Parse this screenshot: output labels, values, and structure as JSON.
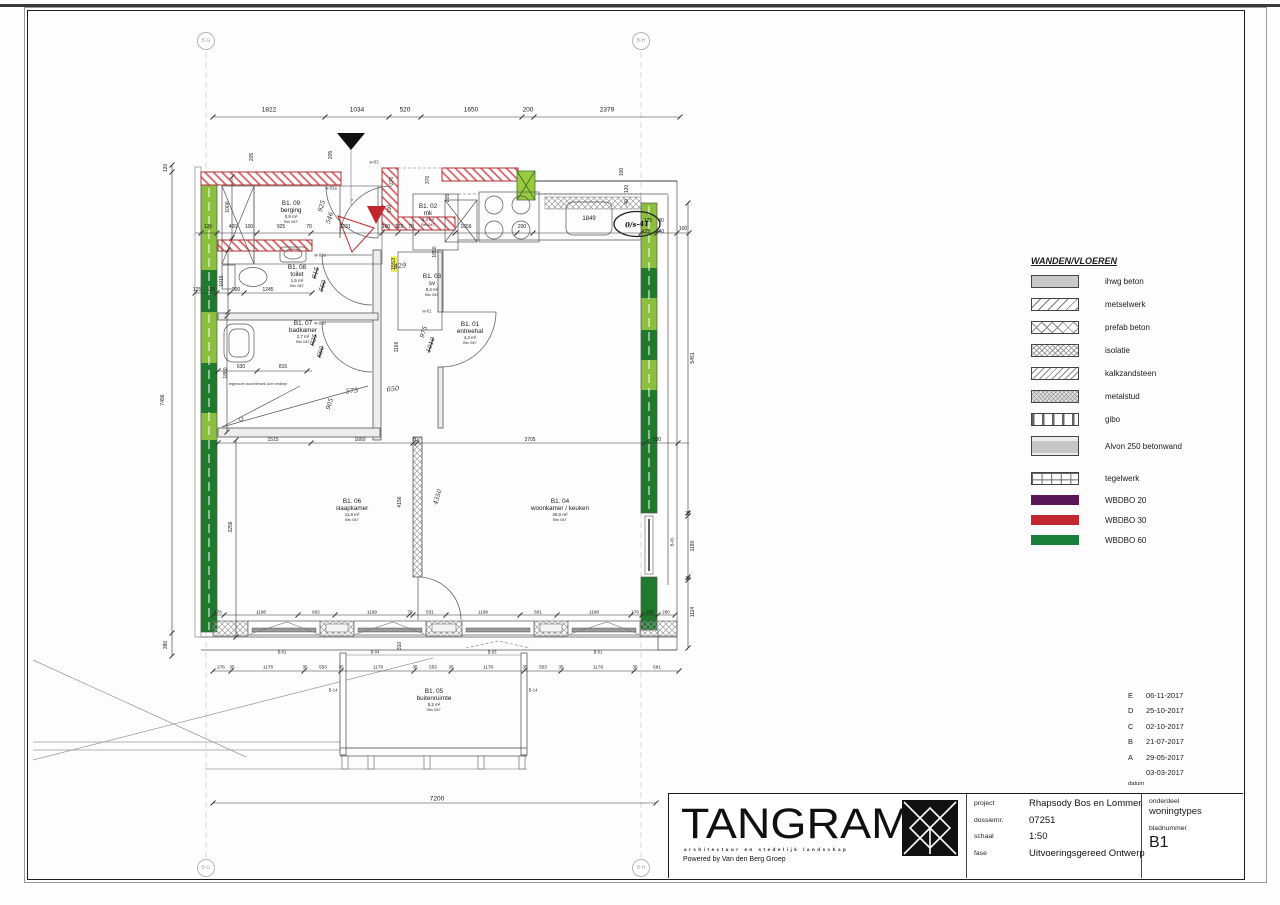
{
  "colors": {
    "accent_red": "#c1272d",
    "green_light": "#8cbf3f",
    "green_dark": "#1f7a2d",
    "purple": "#5a1758",
    "green_legend": "#188038",
    "highlight": "#f3ef52"
  },
  "grid_markers": [
    {
      "label": "B-G",
      "x": 206,
      "y": 41
    },
    {
      "label": "B-H",
      "x": 641,
      "y": 41
    },
    {
      "label": "B-G",
      "x": 206,
      "y": 868
    },
    {
      "label": "B-H",
      "x": 641,
      "y": 868
    }
  ],
  "legend": {
    "title": "WANDEN/VLOEREN",
    "items": [
      {
        "label": "ihwg beton",
        "pattern": "solid"
      },
      {
        "label": "metselwerk",
        "pattern": "diag"
      },
      {
        "label": "prefab beton",
        "pattern": "crossx"
      },
      {
        "label": "isolatie",
        "pattern": "dense"
      },
      {
        "label": "kalkzandsteen",
        "pattern": "diag2"
      },
      {
        "label": "metalstud",
        "pattern": "metal"
      },
      {
        "label": "gibo",
        "pattern": "vbars"
      },
      {
        "label": "Alvon 250 betonwand",
        "pattern": "alvon"
      },
      {
        "label": "tegelwerk",
        "pattern": "tiles",
        "gap": true
      },
      {
        "label": "WBDBO 20",
        "pattern": "bar",
        "color": "#5a1758"
      },
      {
        "label": "WBDBO 30",
        "pattern": "bar",
        "color": "#c1272d"
      },
      {
        "label": "WBDBO 60",
        "pattern": "bar",
        "color": "#188038"
      }
    ]
  },
  "revisions": {
    "rows": [
      {
        "letter": "E",
        "date": "06-11-2017"
      },
      {
        "letter": "D",
        "date": "25-10-2017"
      },
      {
        "letter": "C",
        "date": "02-10-2017"
      },
      {
        "letter": "B",
        "date": "21-07-2017"
      },
      {
        "letter": "A",
        "date": "29-05-2017"
      },
      {
        "letter": "",
        "date": "03-03-2017"
      }
    ],
    "footer": "datum"
  },
  "titleblock": {
    "logo_text": "TANGRAM",
    "logo_tagline": "architectuur en stedelijk landschap",
    "logo_powered": "Powered by Van den Berg Groep",
    "fields": [
      {
        "label": "project",
        "value": "Rhapsody Bos en Lommer"
      },
      {
        "label": "dossiernr.",
        "value": "07251"
      },
      {
        "label": "schaal",
        "value": "1:50"
      },
      {
        "label": "fase",
        "value": "Uitvoeringsgereed Ontwerp"
      }
    ],
    "onderdeel_label": "onderdeel",
    "onderdeel_value": "woningtypes",
    "bladnummer_label": "bladnummer",
    "bladnummer_value": "B1"
  },
  "rooms": [
    {
      "id": "B1. 09",
      "name": "berging",
      "area": "0,9 m²",
      "code": "Brv 047",
      "x": 291,
      "y": 212
    },
    {
      "id": "B1. 08",
      "name": "toilet",
      "area": "1,5 m²",
      "code": "Brv 047",
      "x": 297,
      "y": 276
    },
    {
      "id": "B1. 07",
      "name": "badkamer",
      "area": "2,7 m²",
      "code": "Brv 047",
      "x": 303,
      "y": 332
    },
    {
      "id": "B1. 01",
      "name": "entreehal",
      "area": "4,4 m²",
      "code": "Brv 047",
      "x": 470,
      "y": 333
    },
    {
      "id": "B1. 02",
      "name": "mk",
      "area": "0,3 m²",
      "code": "Brv 047",
      "x": 428,
      "y": 215
    },
    {
      "id": "B1. 03",
      "name": "sv",
      "area": "0,4 m²",
      "code": "Brv 047",
      "x": 432,
      "y": 285
    },
    {
      "id": "B1. 06",
      "name": "slaapkamer",
      "area": "11,8 m²",
      "code": "Brv 047",
      "x": 352,
      "y": 510
    },
    {
      "id": "B1. 04",
      "name": "woonkamer / keuken",
      "area": "26,0 m²",
      "code": "Brv 047",
      "x": 560,
      "y": 510
    },
    {
      "id": "B1. 05",
      "name": "buitenruimte",
      "area": "5,2 m²",
      "code": "Brv 047",
      "x": 434,
      "y": 700
    }
  ],
  "plan_labels": [
    [
      "1822",
      269,
      110,
      "dB"
    ],
    [
      "1034",
      357,
      110,
      "dB"
    ],
    [
      "520",
      405,
      110,
      "dB"
    ],
    [
      "1650",
      471,
      110,
      "dB"
    ],
    [
      "200",
      528,
      110,
      "dB"
    ],
    [
      "2379",
      607,
      110,
      "dB"
    ],
    [
      "125",
      208,
      227,
      "d"
    ],
    [
      "420",
      233,
      227,
      "d"
    ],
    [
      "100",
      249,
      227,
      "d"
    ],
    [
      "925",
      281,
      227,
      "d"
    ],
    [
      "70",
      309,
      227,
      "d"
    ],
    [
      "1231",
      345,
      227,
      "d"
    ],
    [
      "100",
      386,
      227,
      "d"
    ],
    [
      "329",
      399,
      227,
      "d"
    ],
    [
      "70",
      411,
      227,
      "d"
    ],
    [
      "1656",
      466,
      227,
      "d"
    ],
    [
      "200",
      522,
      227,
      "d"
    ],
    [
      "1849",
      589,
      219,
      "d6"
    ],
    [
      "125",
      648,
      221,
      "d"
    ],
    [
      "40",
      661,
      221,
      "d"
    ],
    [
      "125",
      646,
      232,
      "d"
    ],
    [
      "140",
      660,
      232,
      "d"
    ],
    [
      "100",
      683,
      229,
      "d"
    ],
    [
      "120",
      166,
      168,
      "v"
    ],
    [
      "7496",
      163,
      400,
      "v"
    ],
    [
      "380",
      166,
      645,
      "v"
    ],
    [
      "205",
      252,
      157,
      "v"
    ],
    [
      "1000",
      228,
      207,
      "v"
    ],
    [
      "1015",
      222,
      281,
      "v"
    ],
    [
      "1880",
      226,
      373,
      "v"
    ],
    [
      "3256",
      231,
      527,
      "v"
    ],
    [
      "205",
      331,
      155,
      "v"
    ],
    [
      "276",
      392,
      181,
      "v"
    ],
    [
      "376",
      428,
      180,
      "v"
    ],
    [
      "205",
      448,
      198,
      "v"
    ],
    [
      "100",
      390,
      209,
      "v"
    ],
    [
      "1650",
      435,
      252,
      "v"
    ],
    [
      "1553",
      394,
      264,
      "vh"
    ],
    [
      "1166",
      397,
      347,
      "v"
    ],
    [
      "4156",
      400,
      502,
      "v"
    ],
    [
      "310",
      400,
      646,
      "v"
    ],
    [
      "100",
      622,
      172,
      "v"
    ],
    [
      "120",
      627,
      189,
      "v"
    ],
    [
      "40",
      627,
      202,
      "v"
    ],
    [
      "5451",
      693,
      358,
      "v"
    ],
    [
      "35",
      688,
      514,
      "d"
    ],
    [
      "1180",
      693,
      546,
      "v"
    ],
    [
      "35",
      688,
      579,
      "d"
    ],
    [
      "1114",
      693,
      612,
      "v"
    ],
    [
      "1515",
      273,
      440,
      "d"
    ],
    [
      "1660",
      360,
      440,
      "d"
    ],
    [
      "70",
      415,
      440,
      "d"
    ],
    [
      "3705",
      530,
      440,
      "d"
    ],
    [
      "530",
      657,
      440,
      "d"
    ],
    [
      "125",
      197,
      290,
      "d"
    ],
    [
      "125",
      211,
      290,
      "d"
    ],
    [
      "200",
      236,
      290,
      "d"
    ],
    [
      "1245",
      268,
      290,
      "d"
    ],
    [
      "630",
      241,
      367,
      "d"
    ],
    [
      "815",
      283,
      367,
      "d"
    ],
    [
      "176",
      218,
      612,
      "d45"
    ],
    [
      "1198",
      261,
      612,
      "d45"
    ],
    [
      "602",
      316,
      612,
      "d45"
    ],
    [
      "1199",
      372,
      612,
      "d45"
    ],
    [
      "70",
      410,
      612,
      "d45"
    ],
    [
      "531",
      430,
      612,
      "d45"
    ],
    [
      "1199",
      483,
      612,
      "d45"
    ],
    [
      "601",
      538,
      612,
      "d45"
    ],
    [
      "1198",
      594,
      612,
      "d45"
    ],
    [
      "176",
      635,
      612,
      "d45"
    ],
    [
      "255",
      650,
      612,
      "d45"
    ],
    [
      "280",
      666,
      612,
      "d45"
    ],
    [
      "276",
      221,
      667,
      "d45"
    ],
    [
      "35",
      232,
      667,
      "d45"
    ],
    [
      "1178",
      268,
      667,
      "d45"
    ],
    [
      "35",
      305,
      667,
      "d45"
    ],
    [
      "553",
      323,
      667,
      "d45"
    ],
    [
      "35",
      341,
      667,
      "d45"
    ],
    [
      "1178",
      378,
      667,
      "d45"
    ],
    [
      "35",
      415,
      667,
      "d45"
    ],
    [
      "553",
      433,
      667,
      "d45"
    ],
    [
      "35",
      451,
      667,
      "d45"
    ],
    [
      "1178",
      488,
      667,
      "d45"
    ],
    [
      "35",
      525,
      667,
      "d45"
    ],
    [
      "553",
      543,
      667,
      "d45"
    ],
    [
      "35",
      561,
      667,
      "d45"
    ],
    [
      "1178",
      598,
      667,
      "d45"
    ],
    [
      "35",
      635,
      667,
      "d45"
    ],
    [
      "681",
      657,
      667,
      "d45"
    ],
    [
      "7200",
      437,
      799,
      "dB"
    ],
    [
      "925",
      322,
      206,
      "hv"
    ],
    [
      "546",
      330,
      218,
      "hv"
    ],
    [
      "915",
      316,
      273,
      "hvs"
    ],
    [
      "560",
      323,
      286,
      "hvs"
    ],
    [
      "925",
      314,
      340,
      "hvs"
    ],
    [
      "660",
      321,
      352,
      "hvs"
    ],
    [
      "905",
      330,
      404,
      "hv"
    ],
    [
      "975",
      424,
      332,
      "hv"
    ],
    [
      "1010",
      431,
      345,
      "hvs"
    ],
    [
      "4350",
      438,
      497,
      "hv"
    ],
    [
      "429",
      400,
      266,
      "h"
    ],
    [
      "575",
      352,
      391,
      "h"
    ],
    [
      "650",
      393,
      389,
      "h"
    ],
    [
      "0/s-41",
      637,
      224,
      "h7"
    ],
    [
      "w-03",
      374,
      162,
      "t"
    ],
    [
      "w-01a",
      331,
      188,
      "t"
    ],
    [
      "w-02a",
      320,
      255,
      "t"
    ],
    [
      "w-02b",
      320,
      323,
      "t"
    ],
    [
      "w-01",
      427,
      311,
      "t"
    ],
    [
      "×",
      352,
      200,
      "t"
    ],
    [
      "B-01",
      282,
      652,
      "t"
    ],
    [
      "B-04",
      375,
      652,
      "t"
    ],
    [
      "B-03",
      492,
      652,
      "t"
    ],
    [
      "B-01",
      598,
      652,
      "t"
    ],
    [
      "B-14",
      333,
      690,
      "t"
    ],
    [
      "B-14",
      533,
      690,
      "t"
    ],
    [
      "B-06",
      672,
      542,
      "tv"
    ],
    [
      "tegenover douchehoek 1cm verdiept",
      258,
      384,
      "n"
    ]
  ]
}
